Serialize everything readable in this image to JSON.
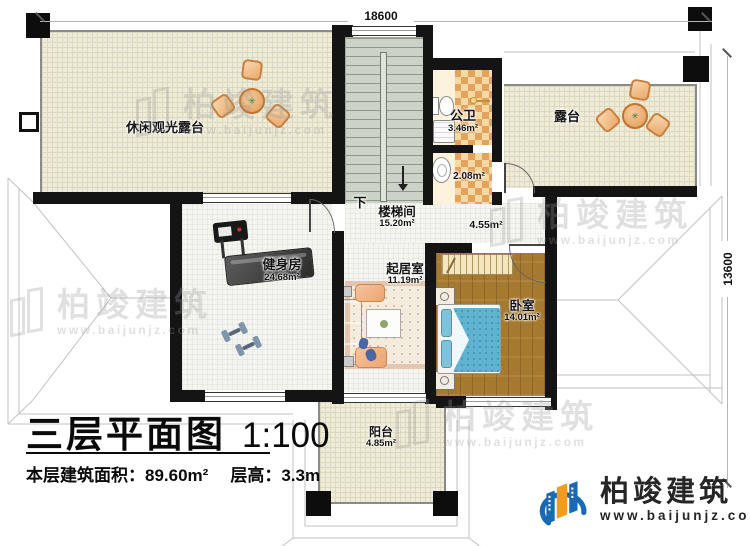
{
  "plan": {
    "title": "三层平面图",
    "scale": "1:100",
    "floor_area_label": "本层建筑面积：",
    "floor_area_value": "89.60m²",
    "floor_height_label": "层高：",
    "floor_height_value": "3.3m",
    "dim_top": "18600",
    "dim_right": "13600",
    "down_label": "下"
  },
  "rooms": {
    "leisure_terrace": {
      "name": "休闲观光露台"
    },
    "stairwell": {
      "name": "楼梯间",
      "area": "15.20m²"
    },
    "public_bath": {
      "name": "公卫",
      "area": "3.46m²"
    },
    "bath_lower": {
      "area": "2.08m²"
    },
    "hall": {
      "area": "4.55m²"
    },
    "terrace": {
      "name": "露台"
    },
    "gym": {
      "name": "健身房",
      "area": "24.68m²"
    },
    "living_room": {
      "name": "起居室",
      "area": "11.19m²"
    },
    "bedroom": {
      "name": "卧室",
      "area": "14.01m²"
    },
    "balcony": {
      "name": "阳台",
      "area": "4.85m²"
    }
  },
  "branding": {
    "company": "柏竣建筑",
    "website": "www.baijunjz.com"
  },
  "colors": {
    "wall": "#141414",
    "terrace_floor": "#eeebd8",
    "wood_floor": "#a5792f",
    "stair_floor": "#ccd2c6",
    "checker_orange": "#e2a35f",
    "checker_cream": "#f6d8a2",
    "logo_blue": "#1a6ab3",
    "logo_orange": "#f59b1c"
  }
}
